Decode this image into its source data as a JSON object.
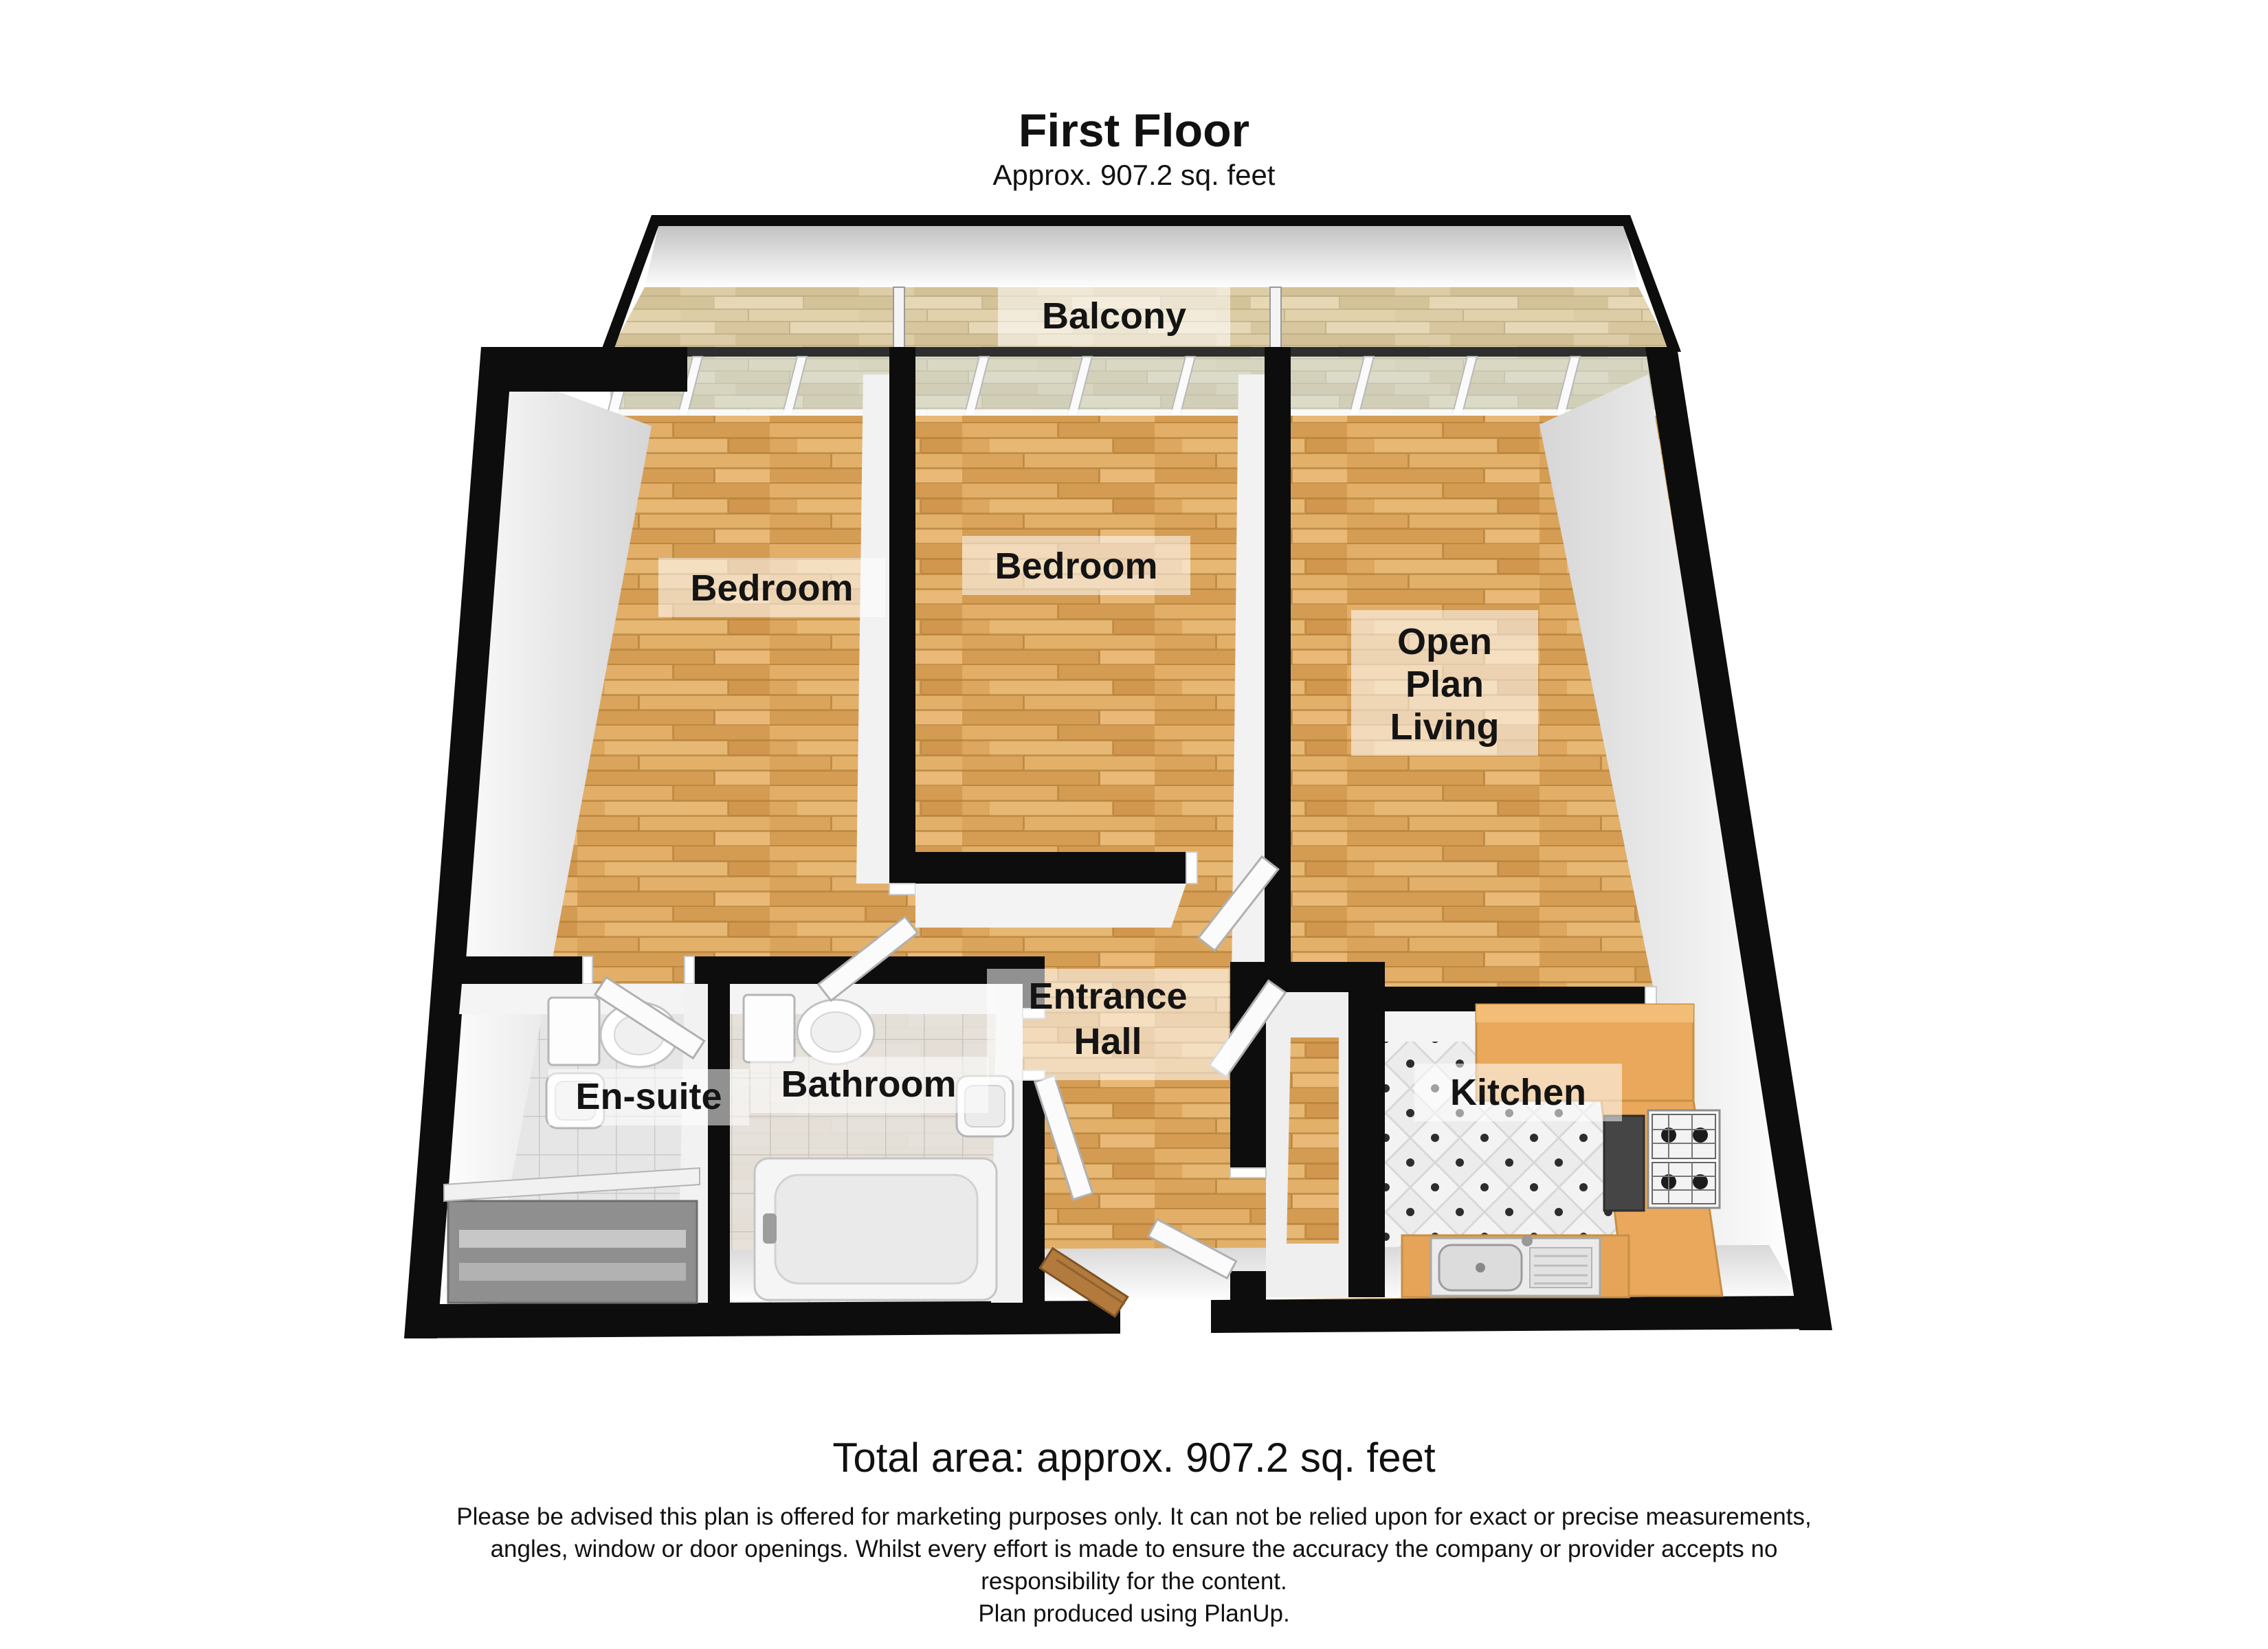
{
  "header": {
    "title": "First Floor",
    "subtitle": "Approx. 907.2 sq. feet"
  },
  "rooms": {
    "balcony": {
      "label": "Balcony"
    },
    "bedroom_left": {
      "label": "Bedroom"
    },
    "bedroom_middle": {
      "label": "Bedroom"
    },
    "open_plan_living": {
      "lines": [
        "Open",
        "Plan",
        "Living"
      ]
    },
    "en_suite": {
      "label": "En-suite"
    },
    "bathroom": {
      "label": "Bathroom"
    },
    "entrance_hall": {
      "lines": [
        "Entrance",
        "Hall"
      ]
    },
    "kitchen": {
      "label": "Kitchen"
    }
  },
  "footer": {
    "total_area": "Total area: approx. 907.2 sq. feet",
    "disclaimer_lines": [
      "Please be advised this plan is offered for marketing purposes only. It can not be relied upon for exact or precise measurements,",
      "angles, window or door openings. Whilst every effort is made to ensure the accuracy the company or provider accepts no",
      "responsibility for the content."
    ],
    "credit": "Plan produced using PlanUp."
  },
  "colors": {
    "wall": "#0d0d0d",
    "wood_base": "#d9a55e",
    "balcony_wood_base": "#ddcda6",
    "glass": "#cfe0e4",
    "kitchen_counter": "#e9a85c",
    "tile": "#e6e6e6",
    "label_text": "#141414"
  }
}
